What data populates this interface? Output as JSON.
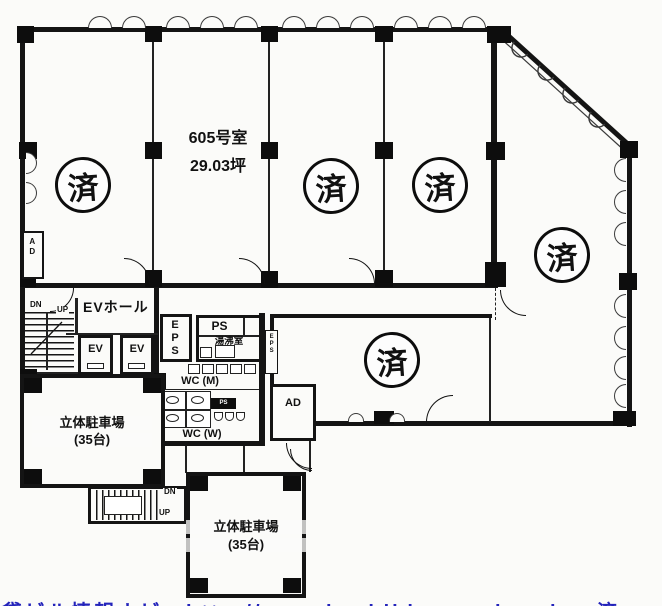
{
  "plan": {
    "room_number": "605号室",
    "room_area": "29.03坪",
    "stamp": "済",
    "ev_hall": "EVホール",
    "ev": "EV",
    "eps": "EPS",
    "eps_side": "EPS",
    "ps": "PS",
    "ps_small": "PS",
    "kitchenette": "湯沸室",
    "wc_m": "WC (M)",
    "wc_w": "WC (W)",
    "ad": "AD",
    "dn": "DN",
    "up": "UP",
    "parking_name": "立体駐車場",
    "parking_capacity": "(35台)",
    "caption": "貸ビル情報ナビ　http://www.kashibiru-navi.co.jp　済",
    "colors": {
      "line": "#141414",
      "caption_blue": "#2323bb",
      "background": "#fbfbf9"
    }
  }
}
